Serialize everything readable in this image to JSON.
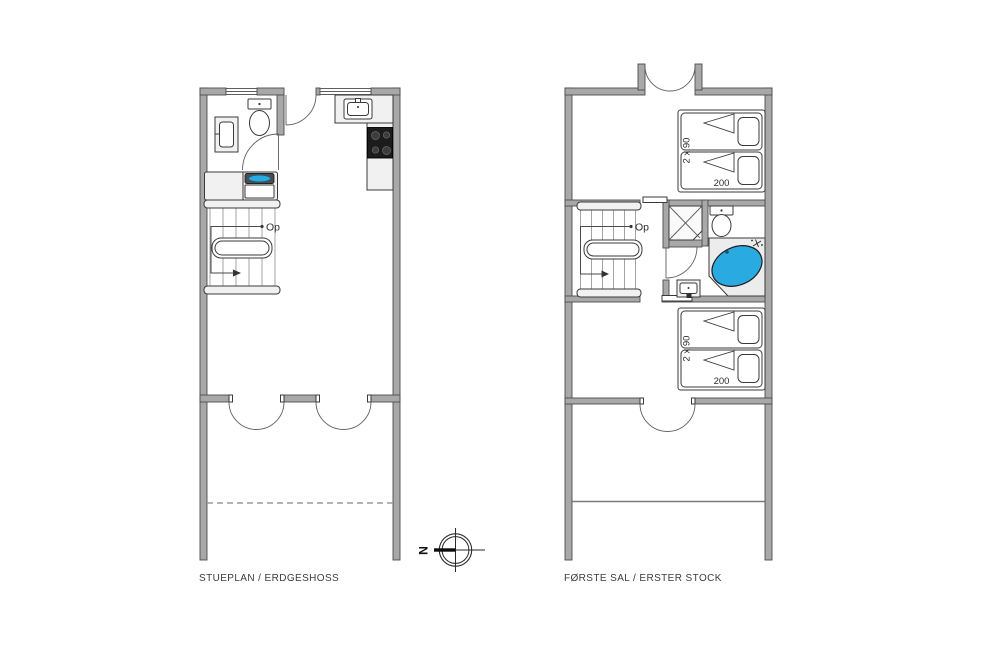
{
  "floors": [
    {
      "id": "ground-floor",
      "label": "STUEPLAN / ERDGESHOSS",
      "stairs": {
        "direction_label": "Op"
      }
    },
    {
      "id": "first-floor",
      "label": "FØRSTE SAL / ERSTER STOCK",
      "stairs": {
        "direction_label": "Op"
      },
      "bedroom_top": {
        "bed_width_label": "2 x 90",
        "bed_length_label": "200"
      },
      "bedroom_bottom": {
        "bed_width_label": "2 x 90",
        "bed_length_label": "200"
      }
    }
  ],
  "compass": {
    "north_label": "N"
  },
  "colors": {
    "wall": "#a8a8a8",
    "wall_outline": "#4d4d4d",
    "fixture_fill": "#f1f1f1",
    "tub_water": "#29abe2",
    "stove": "#1c1c1c",
    "text": "#3c3c3c"
  }
}
